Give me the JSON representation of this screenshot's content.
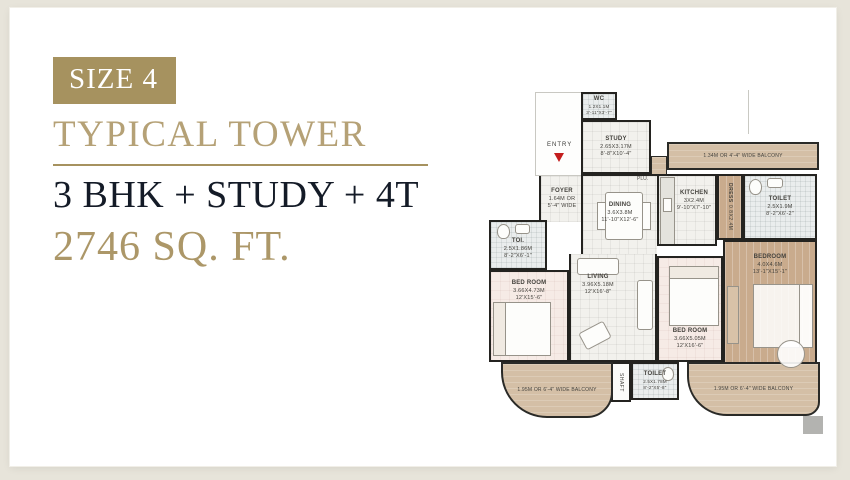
{
  "info": {
    "badge": "SIZE 4",
    "title": "TYPICAL TOWER",
    "config": "3 BHK + STUDY + 4T",
    "area": "2746 SQ. FT."
  },
  "colors": {
    "accent_gold": "#a6925f",
    "title_gold": "#b5a176",
    "dark_navy": "#141b27",
    "wall": "#242320",
    "wood_floor": "#c9ab8d",
    "balcony_floor": "#d4bfa6",
    "entry_arrow": "#c41e1e",
    "card_bg": "#ffffff",
    "page_bg": "#e7e4da"
  },
  "plan": {
    "entry": "ENTRY",
    "plumbing": "PLU.",
    "shaft": "SHAFT",
    "balconies": {
      "top": "1.34M OR 4'-4\" WIDE BALCONY",
      "bottom_left": "1.95M OR 6'-4\" WIDE BALCONY",
      "bottom_right": "1.95M OR 6'-4\" WIDE BALCONY"
    },
    "rooms": [
      {
        "id": "wc",
        "name": "WC",
        "dim_m": "1.2X1.1M",
        "dim_ft": "3'-11\"X3'-7\""
      },
      {
        "id": "study",
        "name": "STUDY",
        "dim_m": "2.65X3.17M",
        "dim_ft": "8'-8\"X10'-4\""
      },
      {
        "id": "foyer",
        "name": "FOYER",
        "dim_m": "1.64M OR",
        "dim_ft": "5'-4\" WIDE"
      },
      {
        "id": "dining",
        "name": "DINING",
        "dim_m": "3.6X3.8M",
        "dim_ft": "11'-10\"X12'-6\""
      },
      {
        "id": "kitchen",
        "name": "KITCHEN",
        "dim_m": "3X2.4M",
        "dim_ft": "9'-10\"X7'-10\""
      },
      {
        "id": "dress",
        "name": "DRESS",
        "dim_m": "0.8X2.4M",
        "dim_ft": ""
      },
      {
        "id": "toilet-top",
        "name": "TOILET",
        "dim_m": "2.5X1.9M",
        "dim_ft": "8'-2\"X6'-2\""
      },
      {
        "id": "bedroom-master",
        "name": "BEDROOM",
        "dim_m": "4.0X4.6M",
        "dim_ft": "13'-1\"X15'-1\""
      },
      {
        "id": "toilet-left",
        "name": "TOI.",
        "dim_m": "2.5X1.86M",
        "dim_ft": "8'-2\"X6'-1\""
      },
      {
        "id": "bedroom-left",
        "name": "BED ROOM",
        "dim_m": "3.66X4.73M",
        "dim_ft": "12'X15'-6\""
      },
      {
        "id": "living",
        "name": "LIVING",
        "dim_m": "3.96X5.18M",
        "dim_ft": "12'X16'-8\""
      },
      {
        "id": "bedroom-bottom",
        "name": "BED ROOM",
        "dim_m": "3.66X5.05M",
        "dim_ft": "12'X16'-6\""
      },
      {
        "id": "toilet-bottom",
        "name": "TOILET",
        "dim_m": "2.5X1.78M",
        "dim_ft": "8'-2\"X5'-8\""
      }
    ]
  }
}
